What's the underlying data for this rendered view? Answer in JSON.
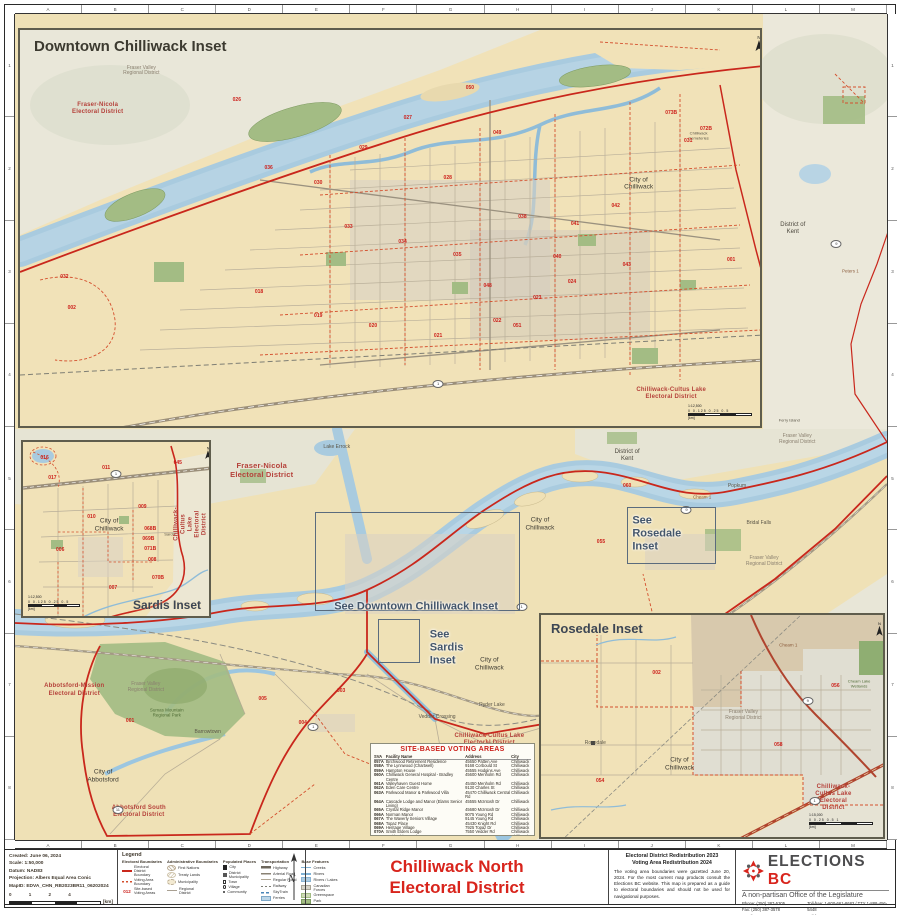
{
  "page": {
    "title_line1": "Chilliwack North",
    "title_line2": "Electoral District"
  },
  "frame": {
    "grid_letters": [
      "A",
      "B",
      "C",
      "D",
      "E",
      "F",
      "G",
      "H",
      "I",
      "J",
      "K",
      "L",
      "M"
    ],
    "grid_numbers": [
      "1",
      "2",
      "3",
      "4",
      "5",
      "6",
      "7",
      "8"
    ]
  },
  "insets": {
    "downtown": {
      "title": "Downtown Chilliwack Inset",
      "ratio": "1:12,500",
      "ticks": "0  0.125  0.25      0.5",
      "unit": "[km]"
    },
    "sardis": {
      "title": "Sardis Inset",
      "ratio": "1:12,500",
      "ticks": "0  0.125  0.25      0.5",
      "unit": "[km]"
    },
    "rosedale": {
      "title": "Rosedale Inset",
      "ratio": "1:15,000",
      "ticks": "0  0.25  0.5         1",
      "unit": "[km]"
    }
  },
  "map_links": [
    "See Downtown Chilliwack Inset",
    "See\nSardis\nInset",
    "See\nRosedale\nInset"
  ],
  "map_labels": {
    "main": [
      {
        "t": "Fraser-Nicola\nElectoral District",
        "x": 28.3,
        "y": 55.3,
        "c": "lbl-red lbl-red-lg"
      },
      {
        "t": "Lake Errock",
        "x": 36.9,
        "y": 52.6,
        "c": "lbl-community"
      },
      {
        "t": "District of\nKent",
        "x": 70.2,
        "y": 53.5,
        "c": "lbl-dark"
      },
      {
        "t": "District of\nKent",
        "x": 89.2,
        "y": 26.0,
        "c": "lbl-dark"
      },
      {
        "t": "Fraser Valley\nRegional District",
        "x": 89.7,
        "y": 51.6,
        "c": "lbl-gray"
      },
      {
        "t": "Fraser Valley\nRegional District",
        "x": 85.9,
        "y": 66.3,
        "c": "lbl-gray"
      },
      {
        "t": "Fraser Valley\nRegional District",
        "x": 15.0,
        "y": 81.6,
        "c": "lbl-gray"
      },
      {
        "t": "Sumas Mountain\nRegional Park",
        "x": 17.4,
        "y": 84.6,
        "c": "lbl-green"
      },
      {
        "t": "City of\nChilliwack",
        "x": 60.2,
        "y": 61.8,
        "c": "lbl-city"
      },
      {
        "t": "City of\nChilliwack",
        "x": 54.4,
        "y": 78.7,
        "c": "lbl-city"
      },
      {
        "t": "Popkum",
        "x": 82.8,
        "y": 57.3,
        "c": "lbl-community"
      },
      {
        "t": "Bridal Falls",
        "x": 85.3,
        "y": 61.7,
        "c": "lbl-community"
      },
      {
        "t": "Abbotsford-Mission\nElectoral District",
        "x": 6.8,
        "y": 81.9,
        "c": "lbl-red"
      },
      {
        "t": "City of\nAbbotsford",
        "x": 10.1,
        "y": 92.3,
        "c": "lbl-city"
      },
      {
        "t": "Abbotsford South\nElectoral District",
        "x": 14.2,
        "y": 96.6,
        "c": "lbl-red"
      },
      {
        "t": "Barrowtown",
        "x": 22.1,
        "y": 87.1,
        "c": "lbl-community"
      },
      {
        "t": "Vedder Crossing",
        "x": 48.4,
        "y": 85.2,
        "c": "lbl-community"
      },
      {
        "t": "Ryder Lake",
        "x": 54.7,
        "y": 83.8,
        "c": "lbl-community"
      },
      {
        "t": "Chilliwack-Cultus Lake\nElectoral District",
        "x": 54.4,
        "y": 87.9,
        "c": "lbl-red"
      },
      {
        "t": "Peters 1",
        "x": 95.8,
        "y": 31.1,
        "c": "lbl-reserve"
      },
      {
        "t": "Ferry Island",
        "x": 88.8,
        "y": 49.3,
        "c": "lbl-community lbl-tiny"
      },
      {
        "t": "Cheam 1",
        "x": 78.8,
        "y": 58.5,
        "c": "lbl-reserve"
      },
      {
        "t": "001",
        "x": 13.2,
        "y": 85.7,
        "c": "lbl-num"
      },
      {
        "t": "003",
        "x": 37.4,
        "y": 82.1,
        "c": "lbl-num"
      },
      {
        "t": "004",
        "x": 33.0,
        "y": 85.9,
        "c": "lbl-num"
      },
      {
        "t": "005",
        "x": 28.4,
        "y": 83.1,
        "c": "lbl-num"
      },
      {
        "t": "055",
        "x": 67.2,
        "y": 64.1,
        "c": "lbl-num"
      },
      {
        "t": "060",
        "x": 70.2,
        "y": 57.3,
        "c": "lbl-num"
      },
      {
        "t": "1",
        "x": 58.1,
        "y": 71.8,
        "c": "lbl-shield"
      },
      {
        "t": "1",
        "x": 34.2,
        "y": 86.3,
        "c": "lbl-shield"
      },
      {
        "t": "9",
        "x": 77.0,
        "y": 60.0,
        "c": "lbl-shield"
      },
      {
        "t": "9",
        "x": 94.2,
        "y": 27.8,
        "c": "lbl-shield"
      },
      {
        "t": "1",
        "x": 83.9,
        "y": 93.6,
        "c": "lbl-shield"
      },
      {
        "t": "11",
        "x": 11.8,
        "y": 96.4,
        "c": "lbl-shield"
      }
    ],
    "downtown": [
      {
        "t": "Fraser Valley\nRegional District",
        "x": 16.4,
        "y": 10.5,
        "c": "lbl-gray"
      },
      {
        "t": "Fraser-Nicola\nElectoral District",
        "x": 10.5,
        "y": 20.0,
        "c": "lbl-red"
      },
      {
        "t": "City of\nChilliwack",
        "x": 83.6,
        "y": 38.8,
        "c": "lbl-city"
      },
      {
        "t": "Chilliwack-Cultus Lake\nElectoral District",
        "x": 88.0,
        "y": 92.0,
        "c": "lbl-red"
      },
      {
        "t": "Chilliwack\nCemeteries",
        "x": 91.7,
        "y": 26.8,
        "c": "lbl-community lbl-tiny"
      },
      {
        "t": "026",
        "x": 29.3,
        "y": 18.0,
        "c": "lbl-num"
      },
      {
        "t": "027",
        "x": 52.4,
        "y": 22.5,
        "c": "lbl-num"
      },
      {
        "t": "028",
        "x": 57.8,
        "y": 37.5,
        "c": "lbl-num"
      },
      {
        "t": "029",
        "x": 46.4,
        "y": 30.0,
        "c": "lbl-num"
      },
      {
        "t": "030",
        "x": 40.3,
        "y": 38.8,
        "c": "lbl-num"
      },
      {
        "t": "031",
        "x": 90.3,
        "y": 28.3,
        "c": "lbl-num"
      },
      {
        "t": "032",
        "x": 6.0,
        "y": 62.5,
        "c": "lbl-num"
      },
      {
        "t": "002",
        "x": 7.0,
        "y": 70.5,
        "c": "lbl-num"
      },
      {
        "t": "033",
        "x": 44.4,
        "y": 50.0,
        "c": "lbl-num"
      },
      {
        "t": "034",
        "x": 51.7,
        "y": 53.8,
        "c": "lbl-num"
      },
      {
        "t": "035",
        "x": 59.1,
        "y": 57.0,
        "c": "lbl-num"
      },
      {
        "t": "036",
        "x": 33.6,
        "y": 35.0,
        "c": "lbl-num"
      },
      {
        "t": "038",
        "x": 67.9,
        "y": 47.5,
        "c": "lbl-num"
      },
      {
        "t": "040",
        "x": 72.6,
        "y": 57.5,
        "c": "lbl-num"
      },
      {
        "t": "041",
        "x": 75.0,
        "y": 49.3,
        "c": "lbl-num"
      },
      {
        "t": "042",
        "x": 80.5,
        "y": 44.8,
        "c": "lbl-num"
      },
      {
        "t": "043",
        "x": 82.0,
        "y": 59.5,
        "c": "lbl-num"
      },
      {
        "t": "048",
        "x": 63.2,
        "y": 65.0,
        "c": "lbl-num"
      },
      {
        "t": "049",
        "x": 64.5,
        "y": 26.3,
        "c": "lbl-num"
      },
      {
        "t": "050",
        "x": 60.8,
        "y": 15.0,
        "c": "lbl-num"
      },
      {
        "t": "051",
        "x": 67.2,
        "y": 75.0,
        "c": "lbl-num"
      },
      {
        "t": "018",
        "x": 32.3,
        "y": 66.3,
        "c": "lbl-num"
      },
      {
        "t": "019",
        "x": 40.3,
        "y": 72.5,
        "c": "lbl-num"
      },
      {
        "t": "020",
        "x": 47.7,
        "y": 75.0,
        "c": "lbl-num"
      },
      {
        "t": "021",
        "x": 56.5,
        "y": 77.5,
        "c": "lbl-num"
      },
      {
        "t": "022",
        "x": 64.5,
        "y": 73.8,
        "c": "lbl-num"
      },
      {
        "t": "023",
        "x": 69.9,
        "y": 68.0,
        "c": "lbl-num"
      },
      {
        "t": "024",
        "x": 74.6,
        "y": 63.8,
        "c": "lbl-num"
      },
      {
        "t": "072B",
        "x": 92.7,
        "y": 25.3,
        "c": "lbl-num"
      },
      {
        "t": "073B",
        "x": 88.0,
        "y": 21.3,
        "c": "lbl-num"
      },
      {
        "t": "001",
        "x": 96.1,
        "y": 58.3,
        "c": "lbl-num"
      },
      {
        "t": "1",
        "x": 56.5,
        "y": 89.3,
        "c": "lbl-shield"
      }
    ],
    "sardis": [
      {
        "t": "City of\nChilliwack",
        "x": 46.3,
        "y": 47.8,
        "c": "lbl-city"
      },
      {
        "t": "Sardis",
        "x": 79.0,
        "y": 53.4,
        "c": "lbl-community lbl-tiny"
      },
      {
        "t": "Chilliwack-Cultus Lake\nElectoral District",
        "x": 90.5,
        "y": 47.0,
        "c": "lbl-red lbl-vert"
      },
      {
        "t": "016",
        "x": 11.6,
        "y": 9.6,
        "c": "lbl-num"
      },
      {
        "t": "017",
        "x": 15.8,
        "y": 21.3,
        "c": "lbl-num"
      },
      {
        "t": "011",
        "x": 44.7,
        "y": 15.7,
        "c": "lbl-num"
      },
      {
        "t": "045",
        "x": 83.2,
        "y": 12.4,
        "c": "lbl-num"
      },
      {
        "t": "009",
        "x": 64.2,
        "y": 38.2,
        "c": "lbl-num"
      },
      {
        "t": "010",
        "x": 36.8,
        "y": 43.8,
        "c": "lbl-num"
      },
      {
        "t": "068B",
        "x": 68.4,
        "y": 50.6,
        "c": "lbl-num"
      },
      {
        "t": "069B",
        "x": 67.4,
        "y": 56.2,
        "c": "lbl-num"
      },
      {
        "t": "071B",
        "x": 68.4,
        "y": 61.8,
        "c": "lbl-num"
      },
      {
        "t": "008",
        "x": 69.5,
        "y": 68.5,
        "c": "lbl-num"
      },
      {
        "t": "070B",
        "x": 72.6,
        "y": 78.7,
        "c": "lbl-num"
      },
      {
        "t": "006",
        "x": 20.0,
        "y": 62.9,
        "c": "lbl-num"
      },
      {
        "t": "007",
        "x": 48.4,
        "y": 84.3,
        "c": "lbl-num"
      },
      {
        "t": "1",
        "x": 50.0,
        "y": 18.5,
        "c": "lbl-shield"
      }
    ],
    "rosedale": [
      {
        "t": "City of\nChilliwack",
        "x": 40.5,
        "y": 67.3,
        "c": "lbl-city"
      },
      {
        "t": "Fraser Valley\nRegional District",
        "x": 59.2,
        "y": 45.6,
        "c": "lbl-gray"
      },
      {
        "t": "Chilliwack-Cultus Lake\nElectoral District",
        "x": 85.5,
        "y": 82.5,
        "c": "lbl-red"
      },
      {
        "t": "Cheam 1",
        "x": 72.3,
        "y": 13.3,
        "c": "lbl-reserve"
      },
      {
        "t": "Cheam Lake\nWetlands",
        "x": 93.0,
        "y": 31.0,
        "c": "lbl-green lbl-tiny"
      },
      {
        "t": "Rosedale",
        "x": 15.9,
        "y": 58.0,
        "c": "lbl-community"
      },
      {
        "t": "002",
        "x": 33.8,
        "y": 26.5,
        "c": "lbl-num"
      },
      {
        "t": "056",
        "x": 86.1,
        "y": 32.3,
        "c": "lbl-num"
      },
      {
        "t": "058",
        "x": 69.4,
        "y": 58.8,
        "c": "lbl-num"
      },
      {
        "t": "054",
        "x": 17.3,
        "y": 75.2,
        "c": "lbl-num"
      },
      {
        "t": "9",
        "x": 78.0,
        "y": 38.9,
        "c": "lbl-shield"
      },
      {
        "t": "1",
        "x": 80.0,
        "y": 84.0,
        "c": "lbl-shield"
      }
    ]
  },
  "voting_table": {
    "title": "SITE-BASED VOTING AREAS",
    "headers": [
      "SVA",
      "Facility Name",
      "Address",
      "City"
    ],
    "rows": [
      {
        "sva": "057A",
        "name": "Birchwood Retirement Residence",
        "addr": "45650 Patten Ave",
        "city": "Chilliwack"
      },
      {
        "sva": "058A",
        "name": "The Lynnwood (Chartwell)",
        "addr": "9168 Corbould St",
        "city": "Chilliwack"
      },
      {
        "sva": "059A",
        "name": "Hampton House",
        "addr": "45555 Hodgins Ave",
        "city": "Chilliwack"
      },
      {
        "sva": "060A",
        "name": "Chilliwack General Hospital - Bradley Centre",
        "addr": "45600 Menholm Rd",
        "city": "Chilliwack"
      },
      {
        "sva": "061A",
        "name": "Valleyhaven Guest Home",
        "addr": "45450 Menholm Rd",
        "city": "Chilliwack"
      },
      {
        "sva": "062A",
        "name": "Eden Care Centre",
        "addr": "9130 Charles St",
        "city": "Chilliwack"
      },
      {
        "sva": "063A",
        "name": "Parkwood Manor & Parkwood Villa",
        "addr": "45470 Chilliwack Central Rd",
        "city": "Chilliwack"
      },
      {
        "sva": "064A",
        "name": "Cascade Lodge and Manor (Elams Senior Living)",
        "addr": "45555 McIntosh Dr",
        "city": "Chilliwack"
      },
      {
        "sva": "065A",
        "name": "Crystal Ridge Manor",
        "addr": "45680 McIntosh Dr",
        "city": "Chilliwack"
      },
      {
        "sva": "066A",
        "name": "Norman Manor",
        "addr": "9075 Young Rd",
        "city": "Chilliwack"
      },
      {
        "sva": "067A",
        "name": "The Waverly Seniors Village",
        "addr": "9145 Young Rd",
        "city": "Chilliwack"
      },
      {
        "sva": "068A",
        "name": "Topaz Place",
        "addr": "45430 Knight Rd",
        "city": "Chilliwack"
      },
      {
        "sva": "069A",
        "name": "Heritage Village",
        "addr": "7925 Topaz Dr",
        "city": "Chilliwack"
      },
      {
        "sva": "070A",
        "name": "Smith Elders Lodge",
        "addr": "7550 Vedder Rd",
        "city": "Chilliwack"
      },
      {
        "sva": "070B",
        "name": "Smith Elders Lodge",
        "addr": "7910 Topaz Dr",
        "city": "Chilliwack"
      },
      {
        "sva": "071A",
        "name": "Auburn Seniors Residence",
        "addr": "9291 Young Rd",
        "city": "Chilliwack"
      },
      {
        "sva": "072A",
        "name": "Cottonwood College",
        "addr": "10170 Cottonwood Dr",
        "city": "Chilliwack"
      }
    ]
  },
  "metadata": {
    "lines": [
      "Created: June 06, 2024",
      "Scale: 1:50,000",
      "Datum: NAD83",
      "Projection: Albers Equal Area Conic",
      "MapID: EDVA_CHN_RB2023BR11_06202024"
    ],
    "scale_ticks": "0    1    2         4",
    "scale_unit": "[km]"
  },
  "legend": {
    "heading": "Legend",
    "groups": [
      {
        "title": "Electoral Boundaries",
        "items": [
          {
            "sw": "sw-line-red",
            "label": "Electoral District Boundary"
          },
          {
            "sw": "sw-dash-red",
            "label": "Voting Area Boundary"
          },
          {
            "sw": "sw-num-red",
            "label": "Site-based Voting Areas"
          }
        ]
      },
      {
        "title": "Administrative Boundaries",
        "items": [
          {
            "sw": "sw-hatch-a",
            "label": "First Nations"
          },
          {
            "sw": "sw-hatch-b",
            "label": "Treaty Lands"
          },
          {
            "sw": "sw-hatch-c",
            "label": "Municipality"
          },
          {
            "sw": "sw-line-gray",
            "label": "Regional District"
          }
        ]
      },
      {
        "title": "Populated Places",
        "items": [
          {
            "sw": "sw-sq-lg",
            "label": "City"
          },
          {
            "sw": "sw-sq-md",
            "label": "District Municipality"
          },
          {
            "sw": "sw-sq-sm",
            "label": "Town"
          },
          {
            "sw": "sw-dot",
            "label": "Village"
          },
          {
            "sw": "sw-dot-sm",
            "label": "Community"
          }
        ]
      },
      {
        "title": "Transportation",
        "items": [
          {
            "sw": "sw-line-hwy",
            "label": "Highway"
          },
          {
            "sw": "sw-line-major",
            "label": "Arterial Road"
          },
          {
            "sw": "sw-line-road",
            "label": "Regular Road"
          },
          {
            "sw": "sw-line-rail",
            "label": "Railway"
          },
          {
            "sw": "sw-line-sky",
            "label": "SkyTrain"
          },
          {
            "sw": "sw-chip-ferry",
            "label": "Ferries"
          }
        ]
      },
      {
        "title": "Base Features",
        "items": [
          {
            "sw": "sw-line-creek",
            "label": "Creeks"
          },
          {
            "sw": "sw-line-river",
            "label": "Rivers"
          },
          {
            "sw": "sw-chip-lake",
            "label": "Rivers / Lakes"
          },
          {
            "sw": "sw-chip-cf",
            "label": "Canadian Forces"
          },
          {
            "sw": "sw-chip-green",
            "label": "Greenspace"
          },
          {
            "sw": "sw-chip-park",
            "label": "Park"
          }
        ]
      }
    ]
  },
  "info_block": {
    "heading1": "Electoral District Redistribution 2023",
    "heading2": "Voting Area Redistribution 2024",
    "paragraph": "The voting area boundaries were gazetted June 20, 2024. For the most current map products consult the Elections BC website. This map is prepared as a guide to electoral boundaries and should not be used for navigational purposes."
  },
  "logo": {
    "name1": "ELECTIONS",
    "name2": "BC",
    "tagline": "A non-partisan Office of the Legislature"
  },
  "contact": {
    "left": [
      "Phone:  (250) 387-5305",
      "Fax:  (250) 387-3578",
      "Email:  electionsbc@elections.bc.ca"
    ],
    "right": [
      "Toll-free:  1-800-661-8683 / TTY 1-888-456-5448",
      "Toll-free Fax:  1-866-466-0665",
      "Website:  www.elections.bc.ca"
    ]
  }
}
